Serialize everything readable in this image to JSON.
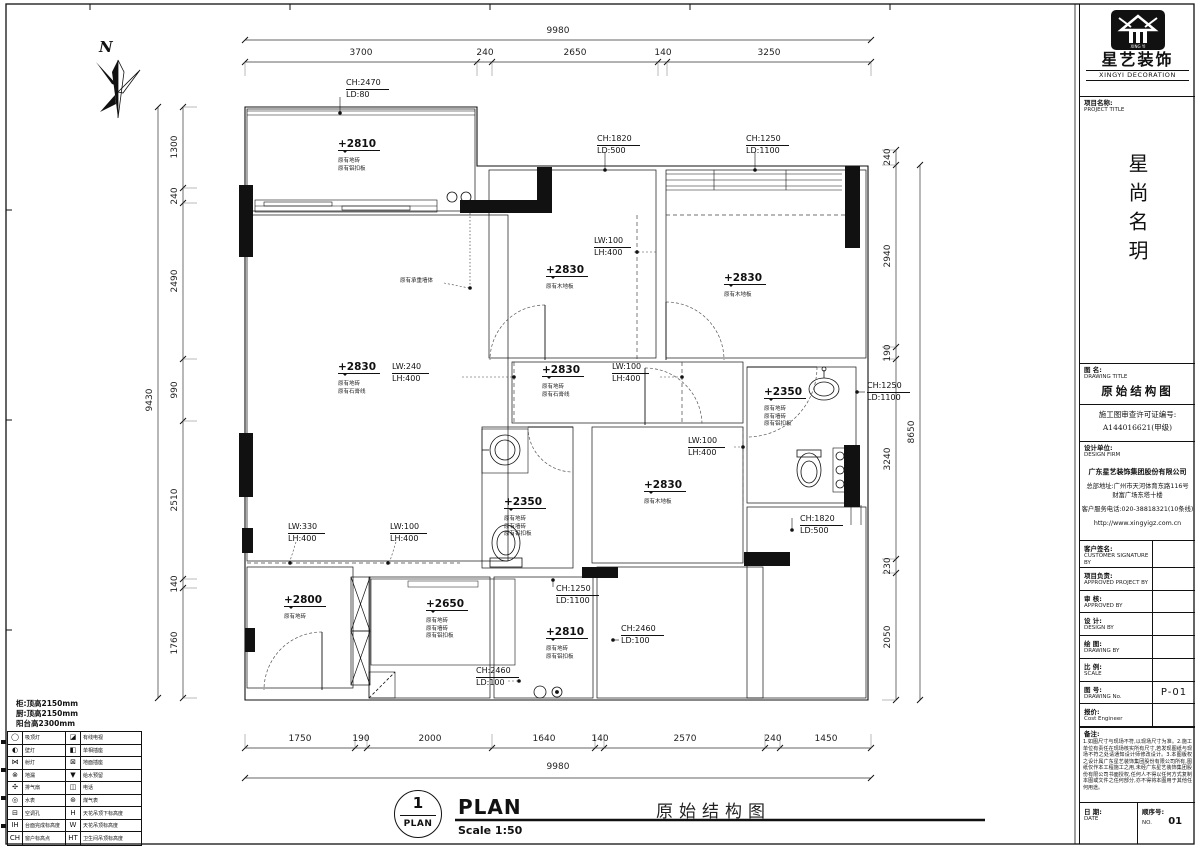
{
  "north": {
    "label": "N"
  },
  "dims": {
    "top_total": "9980",
    "top": [
      "3700",
      "240",
      "2650",
      "140",
      "3250"
    ],
    "bottom": [
      "1750",
      "190",
      "2000",
      "1640",
      "140",
      "2570",
      "240",
      "1450"
    ],
    "bottom_total": "9980",
    "left_total": "9430",
    "left": [
      "1300",
      "240",
      "2490",
      "990",
      "2510",
      "140",
      "1760"
    ],
    "right": [
      "240",
      "2940",
      "190",
      "3240",
      "230",
      "2050"
    ],
    "right_total": "8650"
  },
  "codes": {
    "ch2470": "CH:2470",
    "ld80": "LD:80",
    "ch1820": "CH:1820",
    "ld500": "LD:500",
    "ch1250": "CH:1250",
    "ld1100": "LD:1100",
    "ch2460": "CH:2460",
    "ld100": "LD:100",
    "lw100": "LW:100",
    "lw240": "LW:240",
    "lw330": "LW:330",
    "lh400": "LH:400"
  },
  "levels": {
    "l2810": "+2810",
    "l2830": "+2830",
    "l2350": "+2350",
    "l2800": "+2800",
    "l2650": "+2650"
  },
  "finishes": {
    "floor_tile": "原有地砖",
    "wall_tile": "原有墙砖",
    "alu_ceiling": "原有铝扣板",
    "wood_floor": "原有木地板",
    "plaster_line": "原有石膏线",
    "bearing_wall": "原有承重墙体"
  },
  "footer": {
    "bubble_num": "1",
    "bubble_label": "PLAN",
    "title_en": "PLAN",
    "scale": "Scale 1:50",
    "title_cn": "原始结构图"
  },
  "legend": {
    "notes": [
      "柜:顶高2150mm",
      "厨:顶高2150mm",
      "阳台高2300mm"
    ],
    "rows": [
      {
        "li": "◯",
        "ll": "吸顶灯",
        "ri": "◪",
        "rl": "有线电视"
      },
      {
        "li": "◐",
        "ll": "壁灯",
        "ri": "◧",
        "rl": "单相插座"
      },
      {
        "li": "⋈",
        "ll": "射灯",
        "ri": "⊠",
        "rl": "地面插座"
      },
      {
        "li": "⊗",
        "ll": "地漏",
        "ri": "▼",
        "rl": "给水预留"
      },
      {
        "li": "✣",
        "ll": "排气扇",
        "ri": "◫",
        "rl": "电话"
      },
      {
        "li": "◎",
        "ll": "水表",
        "ri": "⊛",
        "rl": "煤气表"
      },
      {
        "li": "⊟",
        "ll": "空调孔",
        "ri": "H",
        "rl": "天花吊顶下标高度"
      },
      {
        "li": "IH",
        "ll": "台面完成标高度",
        "ri": "W",
        "rl": "天花吊顶标高度"
      },
      {
        "li": "CH",
        "ll": "窗户标高点",
        "ri": "HT",
        "rl": "卫生间吊顶标高度"
      }
    ]
  },
  "title_block": {
    "brand_cn": "星艺装饰",
    "brand_en": "XINGYI DECORATION",
    "project_label": "项目名称:",
    "project_label_en": "PROJECT TITLE",
    "project_name": "星尚名玥",
    "drawing_label": "图 名:",
    "drawing_label_en": "DRAWING TITLE",
    "drawing_title": "原始结构图",
    "permit_line1": "施工图审查许可证编号:",
    "permit_line2": "A144016621(甲级)",
    "design_firm_label": "设计单位:",
    "design_firm_label_en": "DESIGN FIRM",
    "company": "广东星艺装饰集团股份有限公司",
    "address1": "总部地址:广州市天河体育东路116号",
    "address2": "财富广场东塔十楼",
    "phone": "客户服务电话:020-38818321(10条线)",
    "website": "http://www.xingyigz.com.cn",
    "rows": [
      {
        "cn": "客户签名:",
        "en": "CUSTOMER SIGNATURE BY",
        "val": ""
      },
      {
        "cn": "项目负责:",
        "en": "APPROVED PROJECT BY",
        "val": ""
      },
      {
        "cn": "审 核:",
        "en": "APPROVED BY",
        "val": ""
      },
      {
        "cn": "设 计:",
        "en": "DESIGN BY",
        "val": ""
      },
      {
        "cn": "绘 图:",
        "en": "DRAWING BY",
        "val": ""
      },
      {
        "cn": "比 例:",
        "en": "SCALE",
        "val": ""
      },
      {
        "cn": "图 号:",
        "en": "DRAWING No.",
        "val": "P-01"
      },
      {
        "cn": "报价:",
        "en": "Cost Engineer",
        "val": ""
      }
    ],
    "notes_label": "备注:",
    "notes": "1.如图尺寸与现场不符,以现场尺寸为准。2.施工单位有责任在现场核实所有尺寸,若发现图纸与现场不符之处请通知设计师修改设计。3.本图版权之设计属广东星艺装饰集团股份有限公司所有,图纸仅作本工程施工之用,未经广东星艺装饰集团股份有限公司书面授权,任何人不得以任何方式复制本图或文件之任何部分,亦不得将本图用于其他任何用途。",
    "date_cn": "日 期:",
    "date_en": "DATE",
    "seq_cn": "顺序号:",
    "seq_en": "NO.",
    "seq_val": "01"
  }
}
